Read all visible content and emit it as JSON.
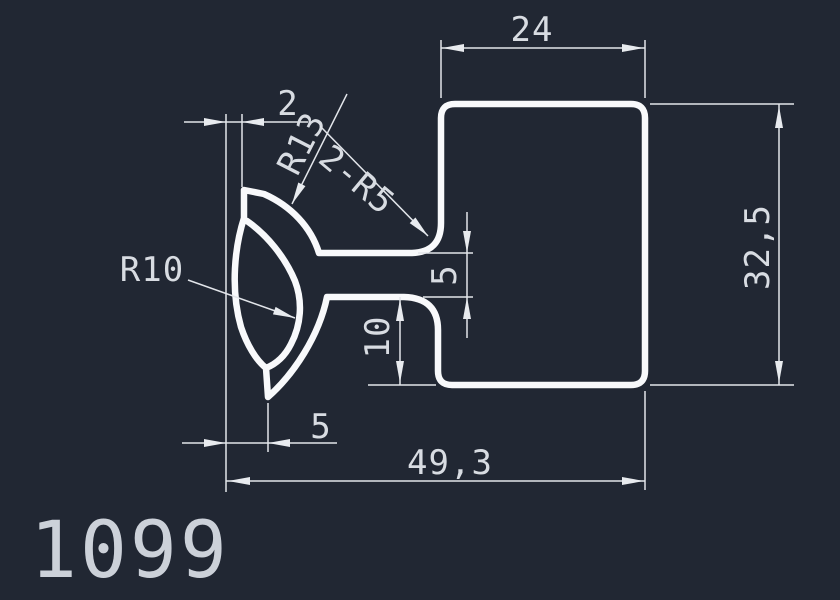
{
  "part_number": "1099",
  "colors": {
    "background": "#212733",
    "profile_line": "#f8f9fb",
    "dimension_line": "#e2e5ea",
    "dimension_text": "#d8dce2",
    "part_number_text": "#ccd1d9"
  },
  "dimensions": {
    "top_width": "24",
    "overall_height": "32,5",
    "overall_width": "49,3",
    "tip_offset": "2",
    "slot_height": "5",
    "step_height": "10",
    "tip_width": "5"
  },
  "callouts": {
    "radius_outer": "R13",
    "radius_inner": "R10",
    "fillets": "2-R5"
  }
}
